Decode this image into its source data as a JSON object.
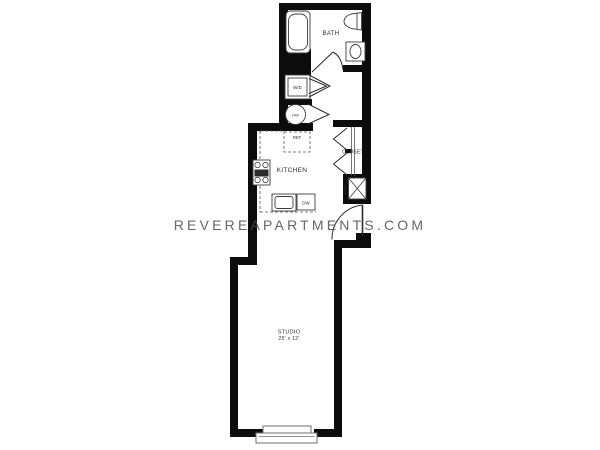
{
  "watermark": {
    "text": "REVEREAPARTMENTS.COM"
  },
  "rooms": {
    "bath": {
      "label": "BATH"
    },
    "kitchen": {
      "label": "KITCHEN"
    },
    "closet": {
      "label": "CLOSET"
    },
    "studio": {
      "label": "STUDIO",
      "dimensions": "25' x 12'"
    }
  },
  "fixtures": {
    "washer_dryer": {
      "label": "W/D"
    },
    "water_heater": {
      "label": "HW"
    },
    "refrigerator": {
      "label": "REF"
    },
    "dishwasher": {
      "label": "DW"
    },
    "hvac": {
      "label": "HVAC"
    }
  },
  "colors": {
    "walls": "#0c0c0c",
    "fixture_lines": "#3d3d3d",
    "background": "#ffffff",
    "watermark": "#4b4b4b"
  }
}
